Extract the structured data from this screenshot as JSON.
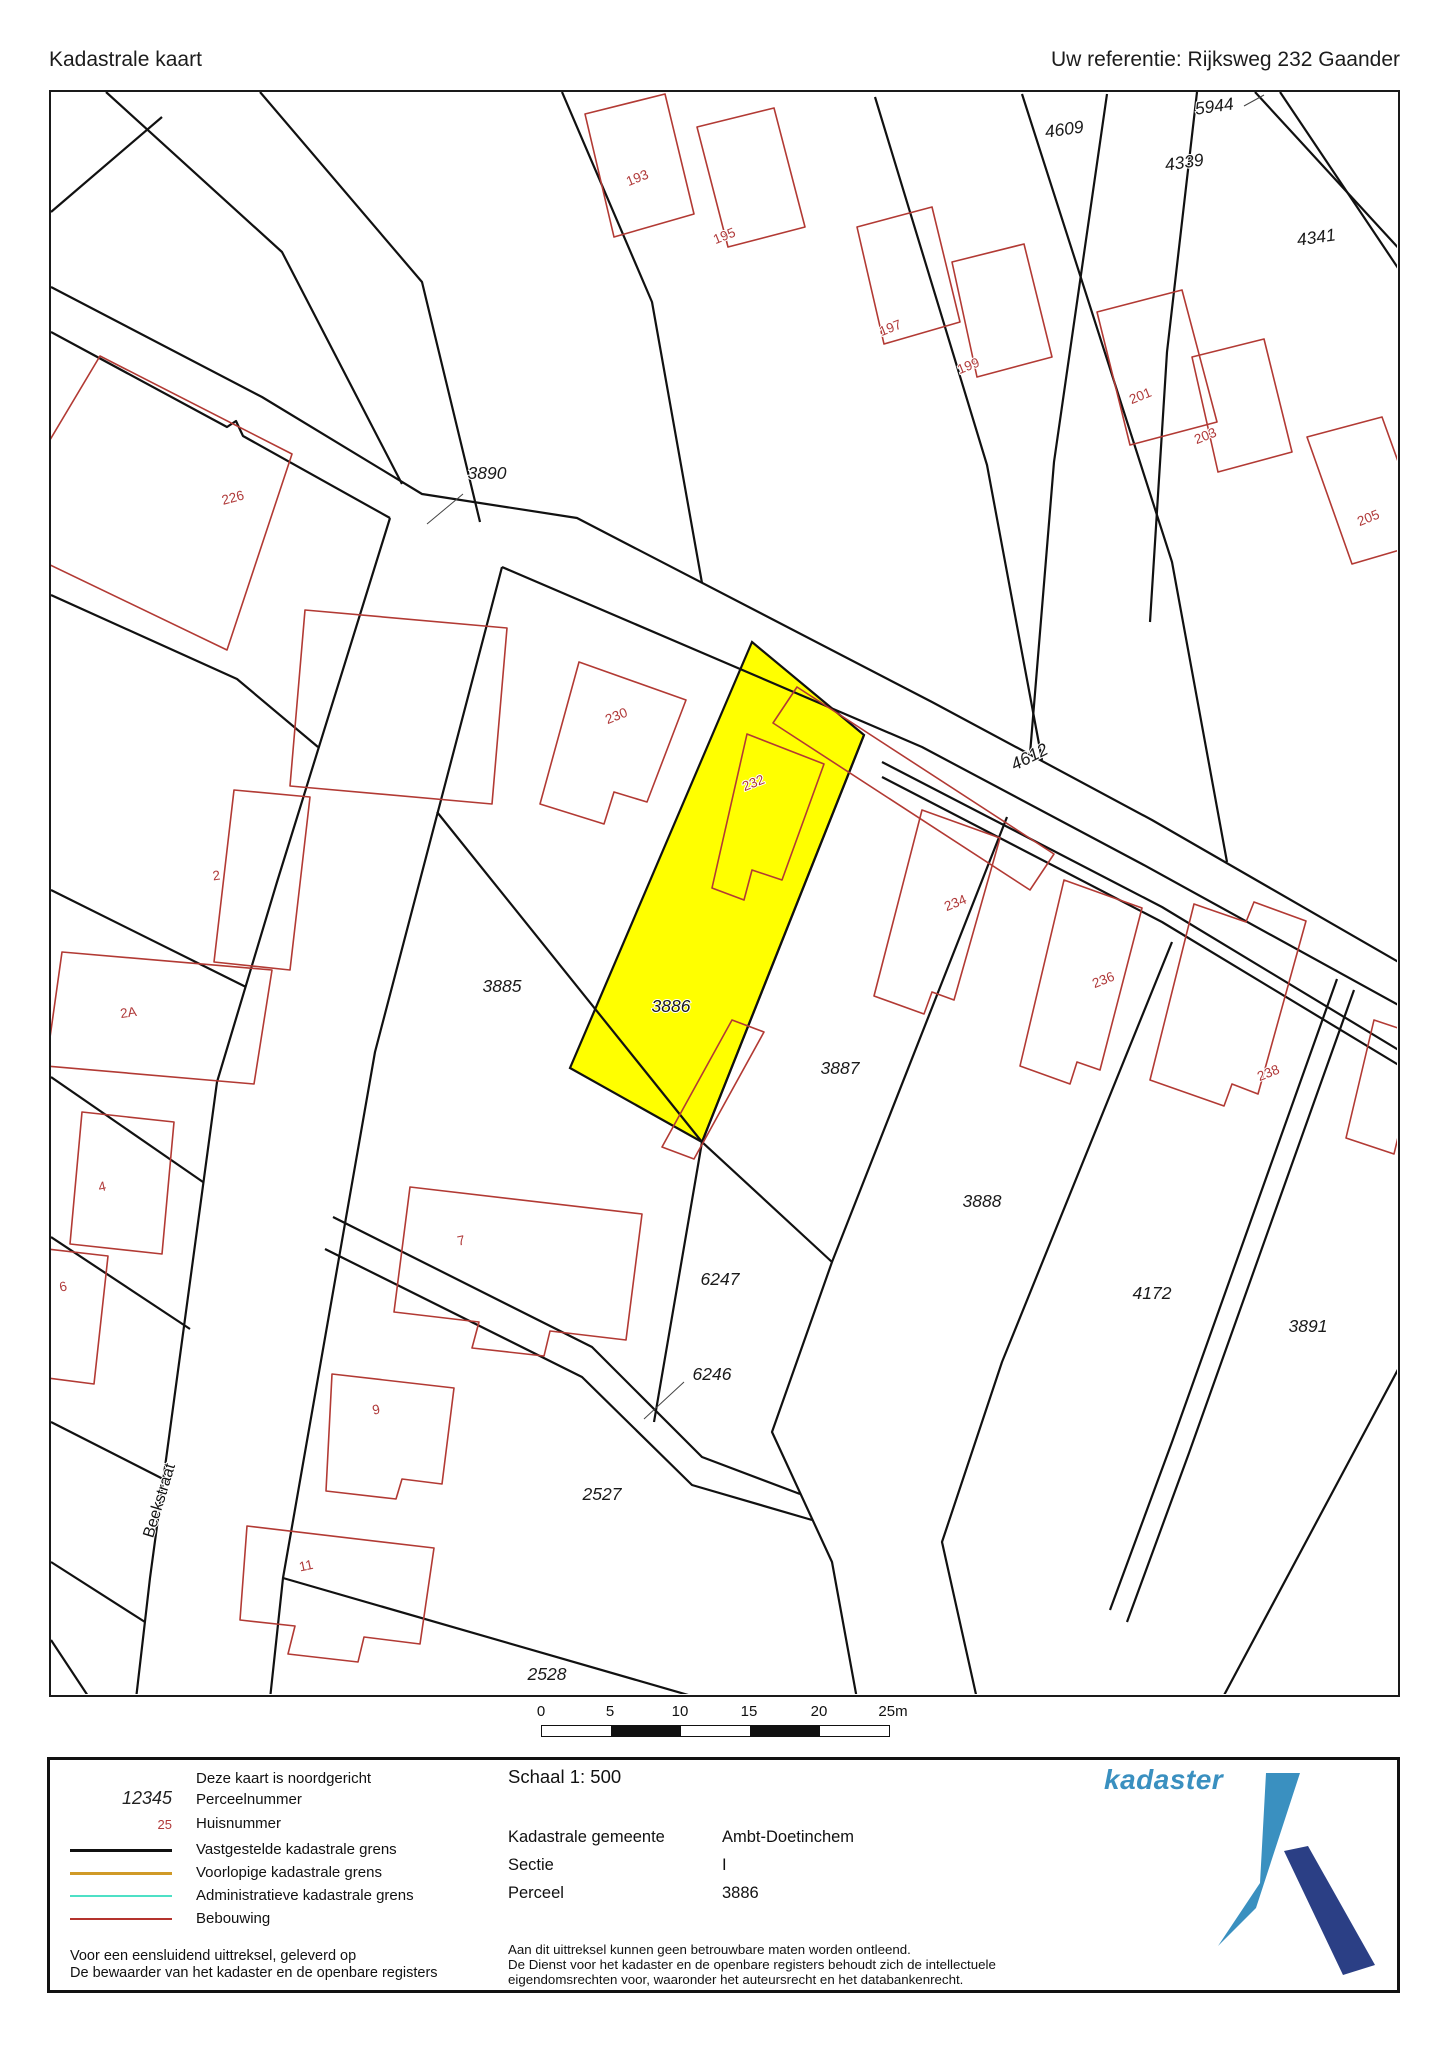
{
  "header": {
    "title": "Kadastrale kaart",
    "reference": "Uw referentie: Rijksweg 232 Gaander"
  },
  "map": {
    "highlight_color": "#ffff00",
    "parcel_number_color": "#1a1a1a",
    "house_number_color": "#b03a3a",
    "parcel_labels": [
      {
        "text": "4609",
        "x": 1063,
        "y": 133,
        "rot": -8
      },
      {
        "text": "5944",
        "x": 1213,
        "y": 110,
        "rot": -8
      },
      {
        "text": "4339",
        "x": 1183,
        "y": 166,
        "rot": -8
      },
      {
        "text": "4341",
        "x": 1315,
        "y": 241,
        "rot": -8
      },
      {
        "text": "3890",
        "x": 485,
        "y": 477,
        "rot": 0
      },
      {
        "text": "4612",
        "x": 1030,
        "y": 760,
        "rot": -27
      },
      {
        "text": "704",
        "x": 30,
        "y": 748,
        "rot": 0
      },
      {
        "text": "3885",
        "x": 500,
        "y": 990,
        "rot": 0
      },
      {
        "text": "3886",
        "x": 669,
        "y": 1010,
        "rot": 0
      },
      {
        "text": "3887",
        "x": 838,
        "y": 1072,
        "rot": 0
      },
      {
        "text": "3888",
        "x": 980,
        "y": 1205,
        "rot": 0
      },
      {
        "text": "4172",
        "x": 1150,
        "y": 1297,
        "rot": 0
      },
      {
        "text": "3891",
        "x": 1306,
        "y": 1330,
        "rot": 0
      },
      {
        "text": "6247",
        "x": 718,
        "y": 1283,
        "rot": 0
      },
      {
        "text": "6246",
        "x": 710,
        "y": 1378,
        "rot": 0
      },
      {
        "text": "2527",
        "x": 600,
        "y": 1498,
        "rot": 0
      },
      {
        "text": "2528",
        "x": 545,
        "y": 1678,
        "rot": 0
      }
    ],
    "house_numbers": [
      {
        "text": "193",
        "x": 637,
        "y": 180,
        "rot": -22
      },
      {
        "text": "195",
        "x": 724,
        "y": 238,
        "rot": -22
      },
      {
        "text": "197",
        "x": 890,
        "y": 330,
        "rot": -22
      },
      {
        "text": "199",
        "x": 968,
        "y": 368,
        "rot": -22
      },
      {
        "text": "201",
        "x": 1140,
        "y": 398,
        "rot": -22
      },
      {
        "text": "203",
        "x": 1205,
        "y": 438,
        "rot": -22
      },
      {
        "text": "205",
        "x": 1368,
        "y": 520,
        "rot": -22
      },
      {
        "text": "226",
        "x": 232,
        "y": 500,
        "rot": -15
      },
      {
        "text": "230",
        "x": 616,
        "y": 718,
        "rot": -22
      },
      {
        "text": "232",
        "x": 753,
        "y": 785,
        "rot": -22
      },
      {
        "text": "234",
        "x": 955,
        "y": 905,
        "rot": -22
      },
      {
        "text": "236",
        "x": 1103,
        "y": 982,
        "rot": -22
      },
      {
        "text": "238",
        "x": 1268,
        "y": 1075,
        "rot": -22
      },
      {
        "text": "2",
        "x": 215,
        "y": 878,
        "rot": -8
      },
      {
        "text": "2A",
        "x": 127,
        "y": 1015,
        "rot": -8
      },
      {
        "text": "4",
        "x": 101,
        "y": 1189,
        "rot": -12
      },
      {
        "text": "6",
        "x": 62,
        "y": 1289,
        "rot": -12
      },
      {
        "text": "7",
        "x": 460,
        "y": 1243,
        "rot": -12
      },
      {
        "text": "9",
        "x": 375,
        "y": 1412,
        "rot": -12
      },
      {
        "text": "11",
        "x": 305,
        "y": 1568,
        "rot": -12
      }
    ],
    "street_labels": [
      {
        "text": "Beekstraat",
        "x": 162,
        "y": 1500,
        "rot": -73
      }
    ]
  },
  "scalebar": {
    "ticks": [
      "0",
      "5",
      "10",
      "15",
      "20",
      "25m"
    ]
  },
  "legend": {
    "north_note": "Deze kaart is noordgericht",
    "perceel_sample": "12345",
    "perceel_label": "Perceelnummer",
    "huis_sample": "25",
    "huis_label": "Huisnummer",
    "items": [
      {
        "label": "Vastgestelde kadastrale grens",
        "color": "#111111",
        "thickness": 3
      },
      {
        "label": "Voorlopige kadastrale grens",
        "color": "#d09a28",
        "thickness": 3
      },
      {
        "label": "Administratieve kadastrale grens",
        "color": "#4ee0c6",
        "thickness": 2.5
      },
      {
        "label": "Bebouwing",
        "color": "#b4332d",
        "thickness": 2.5
      }
    ],
    "footer_line1": "Voor een eensluidend uittreksel, geleverd op",
    "footer_line2": "De bewaarder van het kadaster en de openbare registers"
  },
  "details": {
    "scale_label": "Schaal 1: 500",
    "rows": [
      {
        "label": "Kadastrale gemeente",
        "value": "Ambt-Doetinchem"
      },
      {
        "label": "Sectie",
        "value": "I"
      },
      {
        "label": "Perceel",
        "value": "3886"
      }
    ],
    "disclaimer": [
      "Aan dit uittreksel kunnen geen betrouwbare maten worden ontleend.",
      "De Dienst voor het kadaster en de openbare registers behoudt zich de intellectuele",
      "eigendomsrechten voor, waaronder het auteursrecht en het databankenrecht."
    ]
  },
  "logo": {
    "text": "kadaster",
    "light_blue": "#3a90c0",
    "dark_blue": "#2b3f85"
  }
}
